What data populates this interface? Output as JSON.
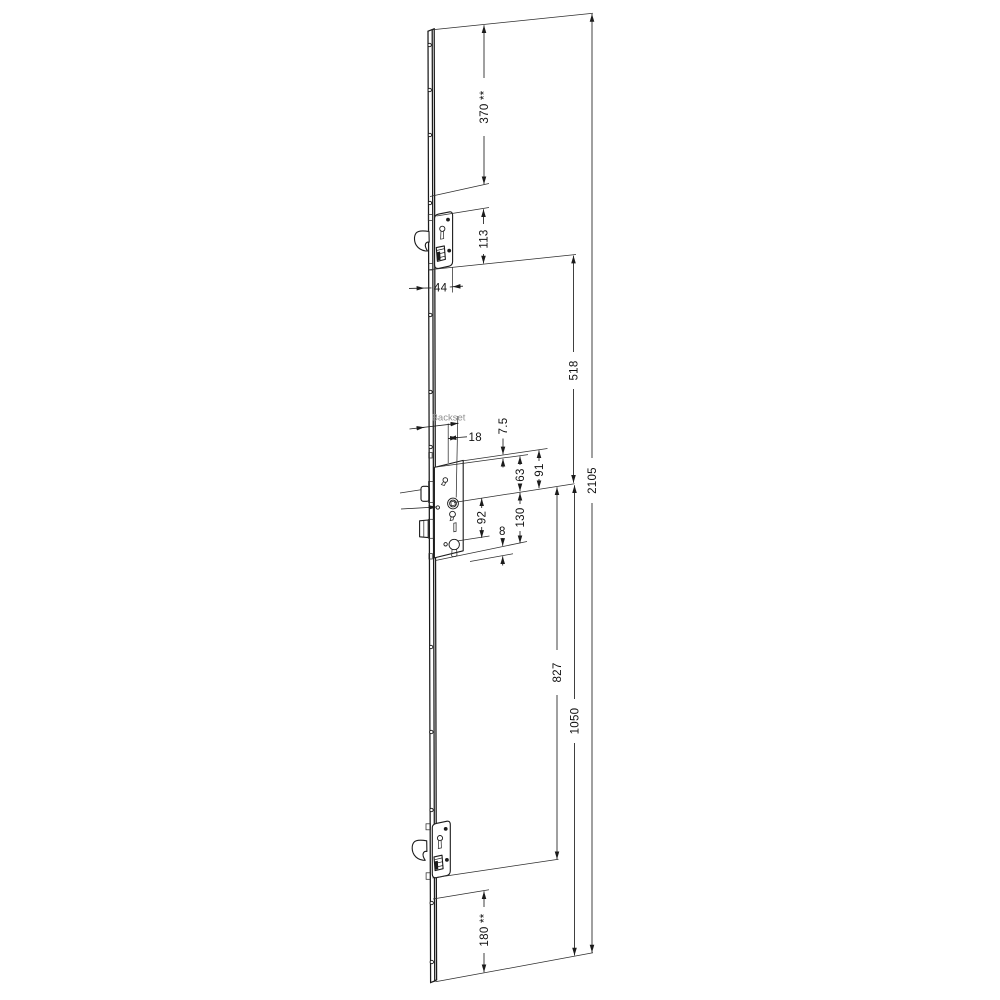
{
  "drawing": {
    "labels": {
      "backset": "Backset",
      "dim_370": "370 **",
      "dim_113": "113",
      "dim_44": "44",
      "dim_18": "18",
      "dim_7_5": "7.5",
      "dim_91": "91",
      "dim_63": "63",
      "dim_92": "92",
      "dim_130": "130",
      "dim_8": "8",
      "dim_518": "518",
      "dim_827": "827",
      "dim_1050": "1050",
      "dim_2105": "2105",
      "dim_180": "180 **"
    },
    "colors": {
      "line": "#1b1b1b",
      "muted_text": "#8f8f8f",
      "background": "#ffffff"
    }
  }
}
